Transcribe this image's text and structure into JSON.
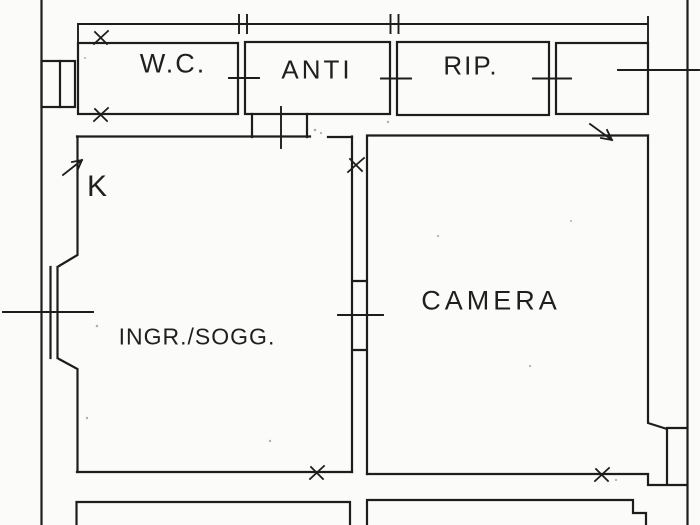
{
  "colors": {
    "line": "#1d1d1d",
    "background": "#fbfbf9",
    "text": "#1f1f1f"
  },
  "rooms": {
    "wc": {
      "label": "W.C."
    },
    "anti": {
      "label": "ANTI"
    },
    "rip": {
      "label": "RIP."
    },
    "kitchen": {
      "label": "K"
    },
    "entry_living": {
      "label": "INGR./SOGG."
    },
    "bedroom": {
      "label": "CAMERA"
    }
  }
}
